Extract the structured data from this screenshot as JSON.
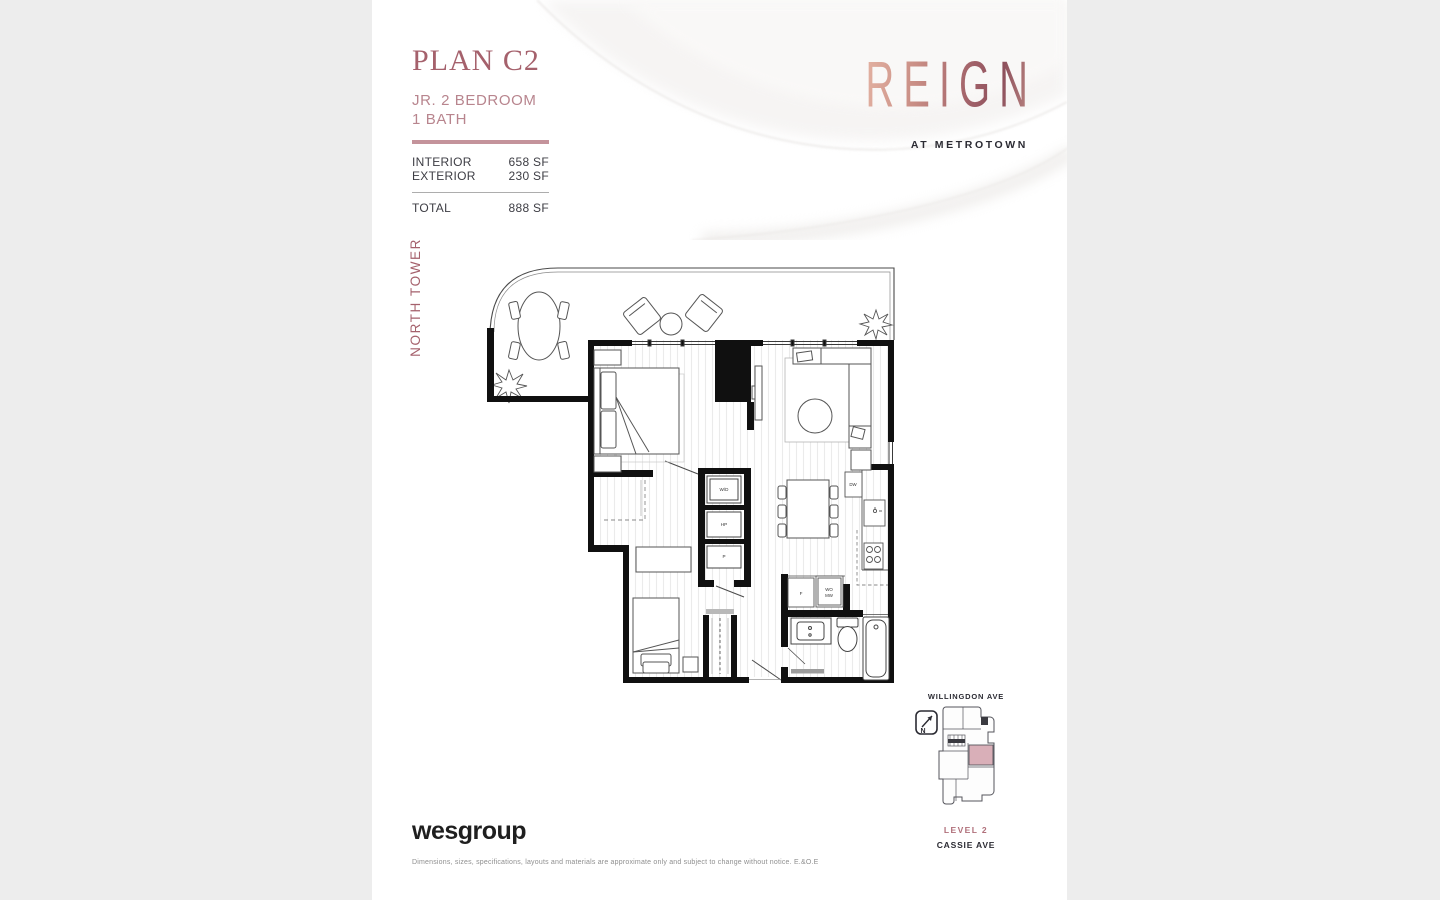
{
  "page": {
    "background": "#ededed",
    "paper": "#ffffff"
  },
  "header": {
    "plan_name": "PLAN C2",
    "subtitle_line1": "JR. 2 BEDROOM",
    "subtitle_line2": "1 BATH",
    "accent_color": "#a5616c",
    "stats": [
      {
        "label": "INTERIOR",
        "value": "658 SF"
      },
      {
        "label": "EXTERIOR",
        "value": "230 SF"
      }
    ],
    "total": {
      "label": "TOTAL",
      "value": "888 SF"
    }
  },
  "brand": {
    "logo_text": "REIGN",
    "tagline": "AT METROTOWN",
    "gradient_from": "#e3b2a2",
    "gradient_to": "#8d505c"
  },
  "tower_label": "NORTH TOWER",
  "floorplan": {
    "labels": {
      "washer_dryer": "W/D",
      "heat_pump": "HP",
      "pantry": "P",
      "dishwasher": "DW",
      "fridge": "F",
      "wall_oven_line1": "WO",
      "wall_oven_line2": "MW"
    }
  },
  "keymap": {
    "street_top": "WILLINGDON AVE",
    "level_label": "LEVEL 2",
    "street_bottom": "CASSIE AVE",
    "north_label": "N",
    "unit_highlight_color": "#d9afb8"
  },
  "footer": {
    "company": "wesgroup",
    "disclaimer": "Dimensions, sizes, specifications, layouts and materials are approximate only and subject to change without notice. E.&O.E"
  }
}
